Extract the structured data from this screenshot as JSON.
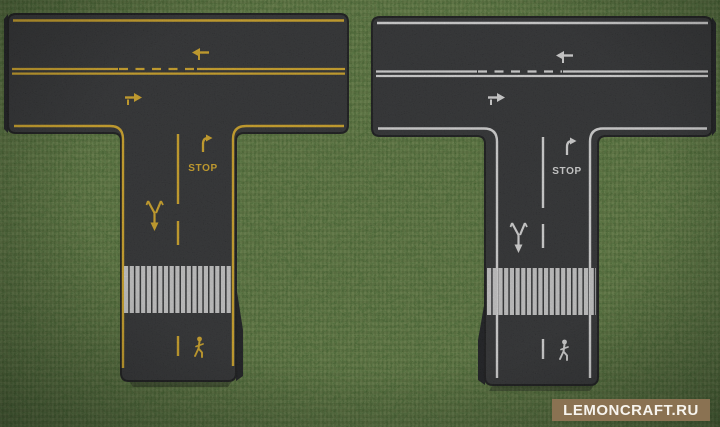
{
  "scene": {
    "game": "Minecraft road blocks showcase",
    "ground": "grass"
  },
  "roads": {
    "left": {
      "shape": "T-intersection",
      "marking_color_name": "yellow",
      "marking_color": "#d2a41f",
      "stop_label": "STOP",
      "markings": [
        "edge-lines",
        "double-center-line",
        "dashed-passing-section",
        "lane-arrow-left",
        "lane-arrow-right",
        "right-turn-arrow",
        "stop-text",
        "merge-arrow",
        "crosswalk",
        "pedestrian-symbol"
      ]
    },
    "right": {
      "shape": "T-intersection",
      "marking_color_name": "white",
      "marking_color": "#d8d8d8",
      "stop_label": "STOP",
      "markings": [
        "edge-lines",
        "double-center-line",
        "dashed-passing-section",
        "lane-arrow-left",
        "lane-arrow-right",
        "right-turn-arrow",
        "stop-text",
        "merge-arrow",
        "crosswalk",
        "pedestrian-symbol"
      ]
    }
  },
  "watermark": {
    "label": "LEMONCRAFT.RU"
  },
  "colors": {
    "grass": "#5b7839",
    "grass_dark": "#46602c",
    "asphalt": "#28292b",
    "yellow": "#d2a41f",
    "white": "#d8d8d8",
    "crosswalk": "#c9c9c9",
    "watermark_bg": "#8a7252",
    "watermark_text": "#f7f4ee"
  }
}
